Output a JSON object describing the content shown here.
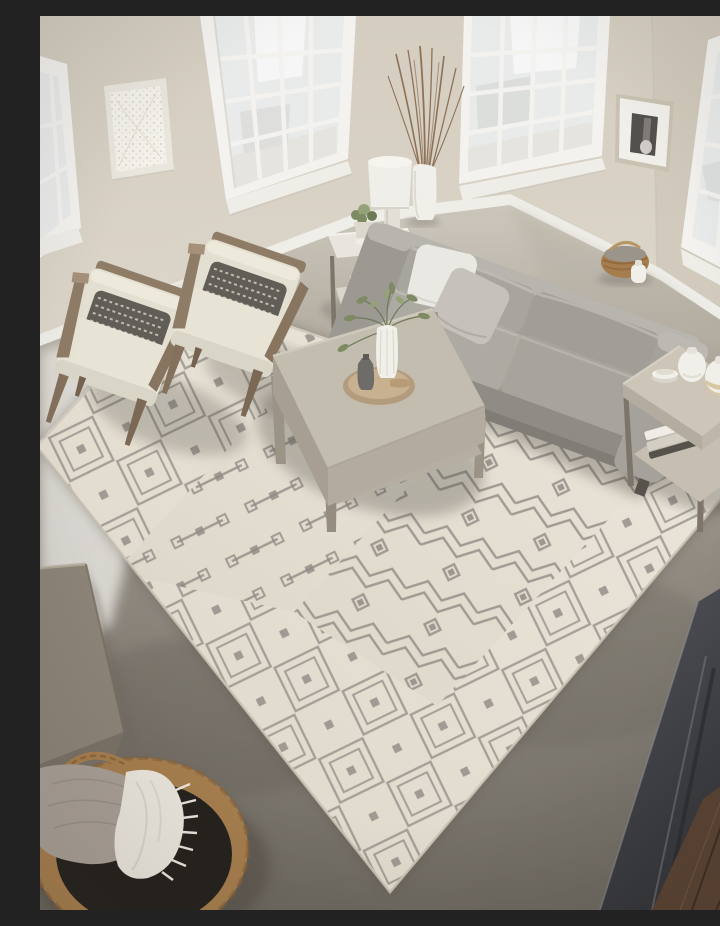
{
  "meta": {
    "title": "Living room with cream Moroccan-trellis area rug",
    "domain": "natural-image"
  },
  "description": "Overhead photo of a bright loft living room: beige walls with tall white grid windows, a gray three-seat sofa, two cream wood-frame accent chairs with patterned lumbar pillows, a square washed-wood coffee table with a tray and greenery vase, side tables with ceramic vases and a white table lamp, all arranged on a large cream rug with a gray Moroccan diamond-trellis pattern over a gray concrete floor; a woven basket with throw blankets sits lower left and a dark loft railing with wood flooring below crosses the lower right corner.",
  "palette": {
    "wall": "#d8d1c5",
    "wallRight": "#d1cabc",
    "windowFrame": "#f3f2ee",
    "glass": "#e9ebea",
    "glassLight": "#f6f7f6",
    "baseboard": "#efede7",
    "floorLight": "#cbc6bb",
    "floorMid": "#8d877d",
    "floorDark": "#6e6960",
    "floorBright": "#e4e2dd",
    "rugBase": "#e8e3d7",
    "rugShade": "#dcd6c8",
    "rugPattern": "#8f8b84",
    "sofa": "#a3a09a",
    "sofaLight": "#b8b5af",
    "sofaDark": "#8f8c86",
    "pillowWhite": "#eae8e2",
    "pillowGreige": "#c6c2bb",
    "chairFabric": "#e3dfd1",
    "chairWood": "#8f7c66",
    "accentPillow": "#615e58",
    "accentPillowPattern": "#d2ccc0",
    "tableTop": "#c3bdb0",
    "tableSide": "#a69f92",
    "metal": "#7d7569",
    "lampShade": "#f0eee9",
    "lampBase": "#e3dfd6",
    "ceramicWhite": "#f1efe9",
    "ceramicTan": "#d9c8a6",
    "greenery": "#7d8a63",
    "greeneryLight": "#95a277",
    "branches": "#8d7257",
    "trayWood": "#b39c7e",
    "basketTan": "#a67e4e",
    "basketDark": "#26231f",
    "blanketCream": "#e9e5dc",
    "blanketGray": "#a99f96",
    "blockTaupe": "#8d8478",
    "railing": "#45464b",
    "railingDark": "#343539",
    "woodFloor": "#5a4334",
    "woodFloorDark": "#3e2d22",
    "photoDark": "#54514d",
    "artBg": "#f3f1ea",
    "artDots": "#d6d2c5"
  },
  "scene": {
    "objects": [
      {
        "name": "window-left-partial",
        "label": "Partial tall window, far left"
      },
      {
        "name": "window-left",
        "label": "Tall white grid window, upper left"
      },
      {
        "name": "window-center",
        "label": "Tall white grid window, upper center"
      },
      {
        "name": "window-right",
        "label": "Tall white grid window, upper right"
      },
      {
        "name": "wall-art",
        "label": "White textured wall art"
      },
      {
        "name": "framed-photo",
        "label": "Small framed black-and-white photo"
      },
      {
        "name": "floor-vase",
        "label": "White floor vase with dried branches"
      },
      {
        "name": "side-table-left",
        "label": "Left end table with lamp, plant and books"
      },
      {
        "name": "table-lamp",
        "label": "White drum-shade table lamp"
      },
      {
        "name": "accent-chair-left",
        "label": "Cream accent chair with wood frame"
      },
      {
        "name": "accent-chair-right",
        "label": "Cream accent chair with wood frame"
      },
      {
        "name": "sofa",
        "label": "Gray three-seat sofa with throw pillows"
      },
      {
        "name": "wall-basket",
        "label": "Small woven basket and white jug behind sofa"
      },
      {
        "name": "coffee-table",
        "label": "Square washed-wood coffee table with tray, vase and greenery"
      },
      {
        "name": "side-table-right",
        "label": "Right end table with ceramic vases, plates and books"
      },
      {
        "name": "area-rug",
        "label": "Cream rug with gray Moroccan trellis pattern"
      },
      {
        "name": "cabinet-corner",
        "label": "Taupe cabinet corner, lower left"
      },
      {
        "name": "blanket-basket",
        "label": "Round woven basket with cream fringe throw and gray blanket"
      },
      {
        "name": "concrete-floor",
        "label": "Polished gray concrete floor"
      },
      {
        "name": "loft-railing",
        "label": "Dark loft railing edge, lower right"
      },
      {
        "name": "wood-floor-below",
        "label": "Dark wood flooring below the railing"
      }
    ]
  }
}
